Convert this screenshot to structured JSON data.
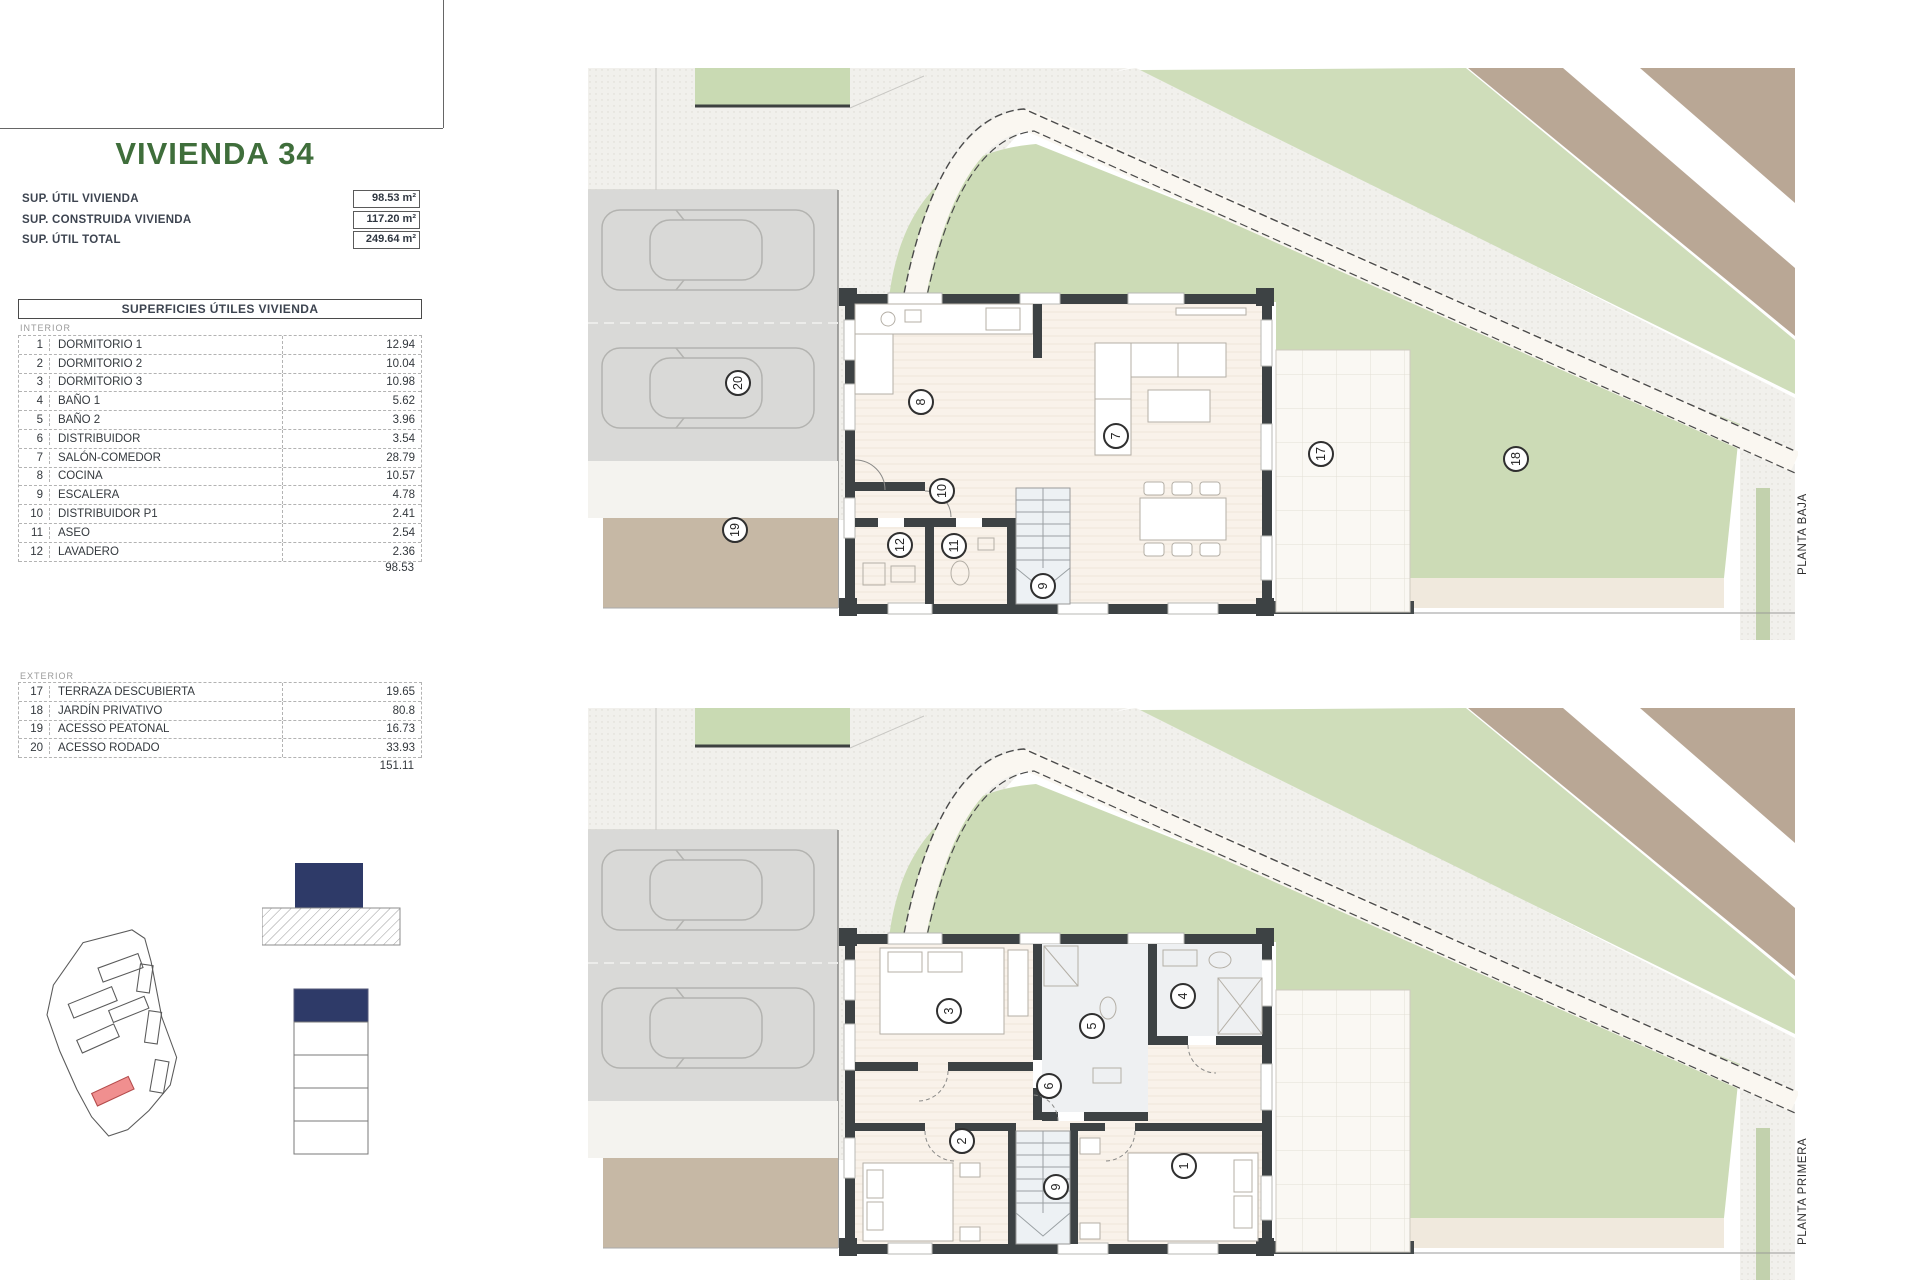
{
  "sheet": {
    "title": "VIVIENDA 34",
    "summary": [
      {
        "label": "SUP. ÚTIL VIVIENDA",
        "value": "98.53 m²"
      },
      {
        "label": "SUP. CONSTRUIDA VIVIENDA",
        "value": "117.20 m²"
      },
      {
        "label": "SUP. ÚTIL TOTAL",
        "value": "249.64 m²"
      }
    ],
    "table": {
      "header": "SUPERFICIES ÚTILES VIVIENDA",
      "interior_label": "INTERIOR",
      "interior_rows": [
        [
          "1",
          "DORMITORIO 1",
          "12.94"
        ],
        [
          "2",
          "DORMITORIO 2",
          "10.04"
        ],
        [
          "3",
          "DORMITORIO 3",
          "10.98"
        ],
        [
          "4",
          "BAÑO 1",
          "5.62"
        ],
        [
          "5",
          "BAÑO 2",
          "3.96"
        ],
        [
          "6",
          "DISTRIBUIDOR",
          "3.54"
        ],
        [
          "7",
          "SALÓN-COMEDOR",
          "28.79"
        ],
        [
          "8",
          "COCINA",
          "10.57"
        ],
        [
          "9",
          "ESCALERA",
          "4.78"
        ],
        [
          "10",
          "DISTRIBUIDOR P1",
          "2.41"
        ],
        [
          "11",
          "ASEO",
          "2.54"
        ],
        [
          "12",
          "LAVADERO",
          "2.36"
        ]
      ],
      "interior_total": "98.53",
      "exterior_label": "EXTERIOR",
      "exterior_rows": [
        [
          "17",
          "TERRAZA DESCUBIERTA",
          "19.65"
        ],
        [
          "18",
          "JARDÍN PRIVATIVO",
          "80.8"
        ],
        [
          "19",
          "ACESSO PEATONAL",
          "16.73"
        ],
        [
          "20",
          "ACESSO RODADO",
          "33.93"
        ]
      ],
      "exterior_total": "151.11"
    }
  },
  "plans": {
    "baja": {
      "label": "PLANTA BAJA",
      "markers": [
        {
          "n": "8",
          "x": 333,
          "y": 334
        },
        {
          "n": "7",
          "x": 528,
          "y": 368
        },
        {
          "n": "10",
          "x": 354,
          "y": 423
        },
        {
          "n": "12",
          "x": 312,
          "y": 477
        },
        {
          "n": "11",
          "x": 366,
          "y": 478
        },
        {
          "n": "9",
          "x": 455,
          "y": 518
        },
        {
          "n": "17",
          "x": 733,
          "y": 386
        },
        {
          "n": "18",
          "x": 928,
          "y": 391
        },
        {
          "n": "19",
          "x": 147,
          "y": 462
        },
        {
          "n": "20",
          "x": 150,
          "y": 315
        }
      ]
    },
    "primera": {
      "label": "PLANTA PRIMERA",
      "markers": [
        {
          "n": "3",
          "x": 361,
          "y": 303
        },
        {
          "n": "5",
          "x": 504,
          "y": 318
        },
        {
          "n": "4",
          "x": 595,
          "y": 288
        },
        {
          "n": "6",
          "x": 461,
          "y": 378
        },
        {
          "n": "2",
          "x": 374,
          "y": 433
        },
        {
          "n": "9",
          "x": 468,
          "y": 479
        },
        {
          "n": "1",
          "x": 596,
          "y": 458
        }
      ]
    }
  },
  "colors": {
    "title_green": "#3f6e3b",
    "garden_green": "#ccdbb6",
    "road_brown": "#b9a795",
    "path_tan": "#c6b8a5",
    "parking_gray": "#d9d9d7",
    "wall_dark": "#3d4244",
    "navy": "#2e3a68",
    "highlight_red": "#f08f8f"
  }
}
